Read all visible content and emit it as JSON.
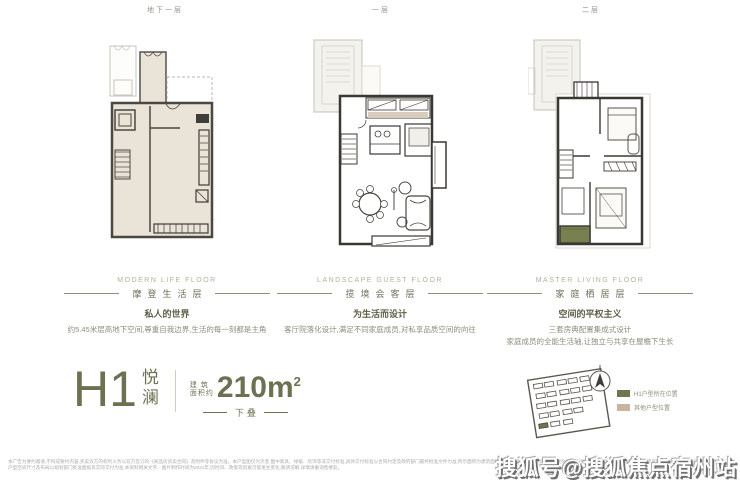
{
  "header": {
    "floor_labels": [
      "地下一层",
      "一层",
      "二层"
    ]
  },
  "floors": [
    {
      "english": "MODERN LIFE FLOOR",
      "title": "摩登生活层",
      "subtitle": "私人的世界",
      "desc1": "约5.45米层高地下空间,尊重自我边界,生活的每一刻都是主角"
    },
    {
      "english": "LANDSCAPE GUEST FLOOR",
      "title": "揽境会客层",
      "subtitle": "为生活而设计",
      "desc1": "客厅院落化设计,满足不同家庭成员,对私享品质空间的向往"
    },
    {
      "english": "MASTER LIVING FLOOR",
      "title": "家庭栖居层",
      "subtitle": "空间的平权主义",
      "desc1": "三套房典配置集成式设计",
      "desc2": "家庭成员的全能生活轴,让独立与共享在屋檐下生长"
    }
  ],
  "unit": {
    "code": "H1",
    "name_top": "悦",
    "name_bottom": "澜",
    "area_label_top": "建 筑",
    "area_label_bottom": "面积约",
    "area_value": "210m",
    "area_sup": "2",
    "stack_label": "下叠"
  },
  "site": {
    "legend": [
      {
        "label": "H1户型所在位置",
        "color": "#6f7550"
      },
      {
        "label": "其他户型位置",
        "color": "#cbb49e"
      }
    ]
  },
  "disclaimer": {
    "line1": "本广告为要约邀请,不构成要约内容,买卖双方的权利义务以双方签订的《商品房买卖合同》及附件等协议为准。本户型图仅为示意,图中家具、绿植、装饰等非交付标准,具体交付标准以合同约定及政府部门最终批准文件为准,所示面积为建筑面积,实际面积以房产测绘部门实测为准,部分图例为效果示意,开发商保留对宣传资料修改的权利,不另行通知。",
    "line2": "户型空间尺寸及布局以规划部门批准图纸及实际交付为准,本资料相关文字、图片制作时间为2021年,因时间、政策等因素可能发生变化,敬请谅解,详情请垂询售楼处。"
  },
  "watermark": {
    "text": "搜狐号@搜狐焦点宿州站"
  },
  "colors": {
    "accent_olive": "#6b7252",
    "legend_green": "#6f7550",
    "legend_beige": "#cbb49e",
    "plan_fill_beige": "#eae3d8",
    "balcony_green": "#77804e",
    "wall_dark": "#3a3832"
  }
}
